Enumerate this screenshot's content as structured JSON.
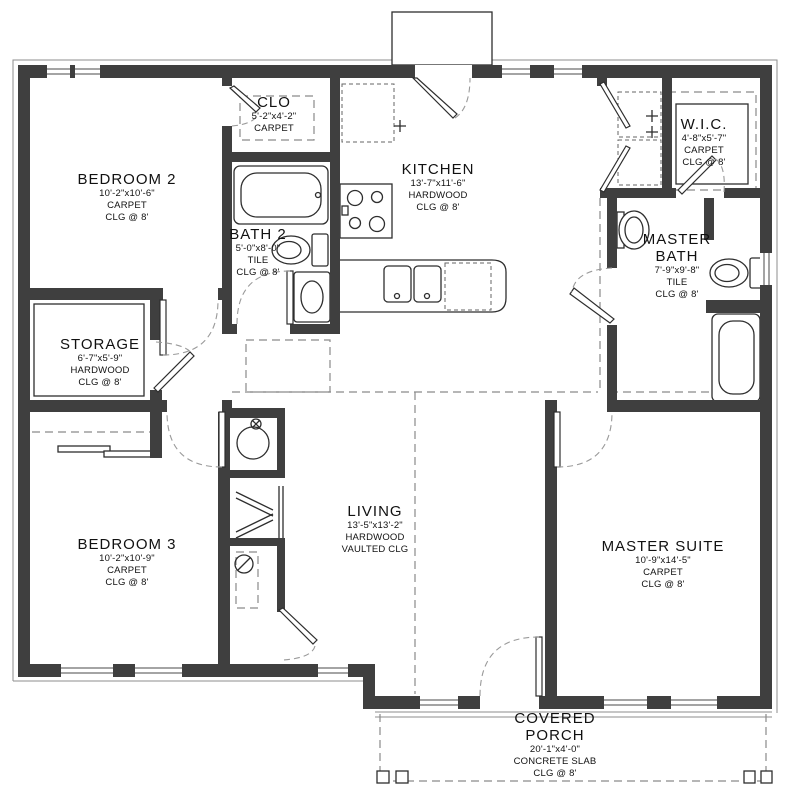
{
  "plan": {
    "colors": {
      "wall": "#3f3f3f",
      "line": "#2e2e2e",
      "dash": "#8a8a8a",
      "background": "#ffffff"
    },
    "rooms": {
      "bedroom2": {
        "name": "BEDROOM 2",
        "dims": "10'-2\"x10'-6\"",
        "floor": "CARPET",
        "ceiling": "CLG @ 8'"
      },
      "clo": {
        "name": "CLO",
        "dims": "5'-2\"x4'-2\"",
        "floor": "CARPET",
        "ceiling": ""
      },
      "kitchen": {
        "name": "KITCHEN",
        "dims": "13'-7\"x11'-6\"",
        "floor": "HARDWOOD",
        "ceiling": "CLG @ 8'"
      },
      "wic": {
        "name": "W.I.C.",
        "dims": "4'-8\"x5'-7\"",
        "floor": "CARPET",
        "ceiling": "CLG @ 8'"
      },
      "bath2": {
        "name": "BATH 2",
        "dims": "5'-0\"x8'-0\"",
        "floor": "TILE",
        "ceiling": "CLG @ 8'"
      },
      "master_bath": {
        "name": "MASTER BATH",
        "dims": "7'-9\"x9'-8\"",
        "floor": "TILE",
        "ceiling": "CLG @ 8'"
      },
      "storage": {
        "name": "STORAGE",
        "dims": "6'-7\"x5'-9\"",
        "floor": "HARDWOOD",
        "ceiling": "CLG @ 8'"
      },
      "bedroom3": {
        "name": "BEDROOM 3",
        "dims": "10'-2\"x10'-9\"",
        "floor": "CARPET",
        "ceiling": "CLG @ 8'"
      },
      "living": {
        "name": "LIVING",
        "dims": "13'-5\"x13'-2\"",
        "floor": "HARDWOOD",
        "ceiling": "VAULTED CLG"
      },
      "master_suite": {
        "name": "MASTER SUITE",
        "dims": "10'-9\"x14'-5\"",
        "floor": "CARPET",
        "ceiling": "CLG @ 8'"
      },
      "covered_porch": {
        "name": "COVERED PORCH",
        "dims": "20'-1\"x4'-0\"",
        "floor": "CONCRETE SLAB",
        "ceiling": "CLG @ 8'"
      }
    }
  }
}
